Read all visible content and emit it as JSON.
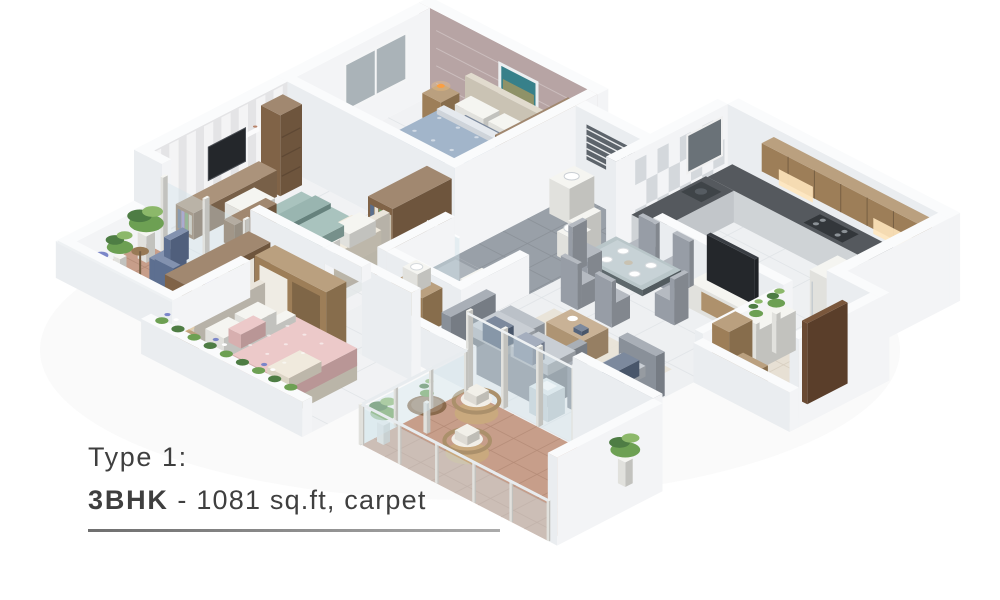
{
  "caption": {
    "line1": "Type 1:",
    "unit_type": "3BHK",
    "details": " - 1081 sq.ft, carpet"
  },
  "colors": {
    "background": "#ffffff",
    "wallTop": "#fafbfc",
    "wallLight": "#f3f4f6",
    "wallDark": "#eaedf0",
    "floorMain": "#eef0f2",
    "floorBed": "#f1f2f4",
    "tileLine": "#dfe3e6",
    "bathFloor": "#99a0a8",
    "balconyFloor": "#c79e8a",
    "balconyLine": "#b48b77",
    "beigeFloor": "#e7e0d4",
    "beigeLine": "#d6cdbe",
    "accentWall": "#b7a4a4",
    "stripeBase": "#e4e4e6",
    "stripeLight": "#f4f4f6",
    "wood": "#a9885f",
    "woodDark": "#8a6a4c",
    "woodDeep": "#6f5538",
    "counter": "#55595e",
    "tvDark": "#24272b",
    "sofa": "#aab1ba",
    "teal": "#93b4ae",
    "cream": "#ece5d4",
    "blueBed": "#8ba3bd",
    "pinkBed": "#e7bcbc",
    "chairBlue": "#64779b",
    "glass": "#d3e4ea",
    "plantGreen": "#6da053",
    "plantDark": "#4e7d44",
    "plantLight": "#8cb86a",
    "flowerViolet": "#7b86c9",
    "lampGlow": "#ffca7a",
    "rattan": "#c9a97e",
    "artTeal": "#37808a",
    "captionText": "#3f3f3f",
    "captionRule": "#7a7a7a"
  }
}
